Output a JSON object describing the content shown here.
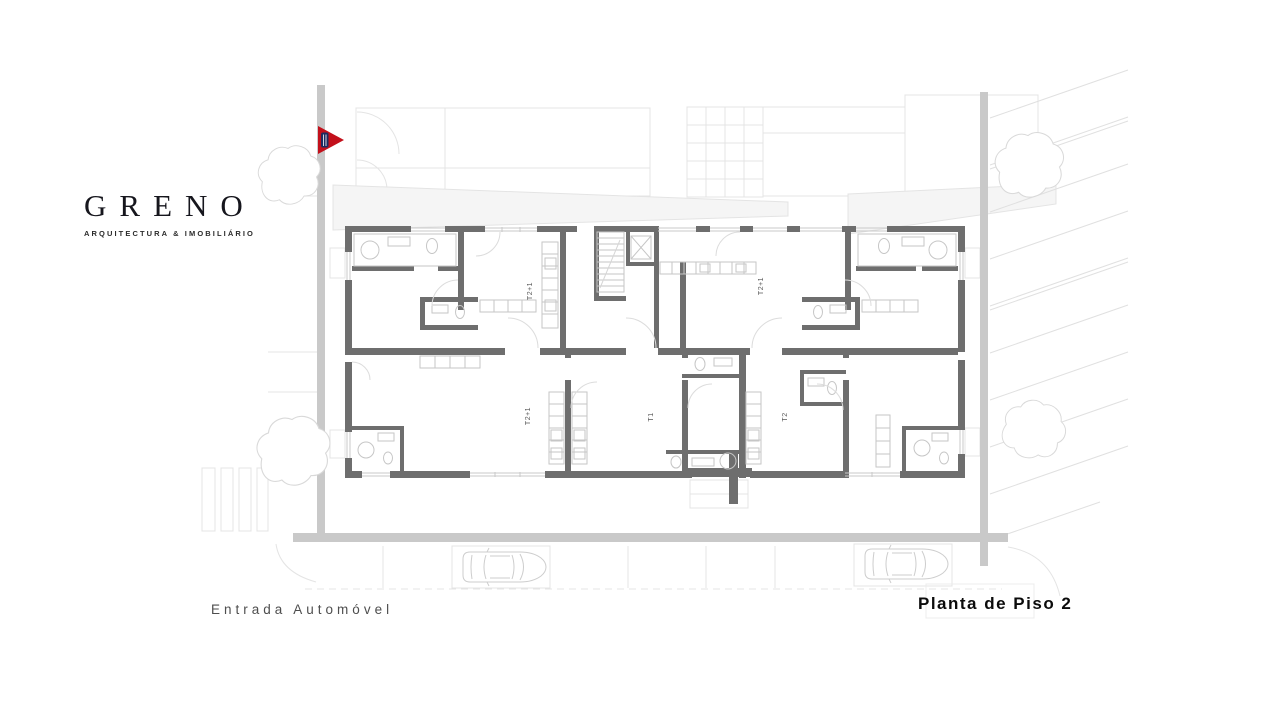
{
  "brand": {
    "name": "GRENO",
    "tagline": "ARQUITECTURA & IMOBILIÁRIO"
  },
  "captions": {
    "car_entrance": "Entrada Automóvel",
    "plan_title": "Planta de Piso 2"
  },
  "floor_plan": {
    "units": [
      {
        "id": "top-left",
        "label": "T2+1"
      },
      {
        "id": "top-right",
        "label": "T2+1"
      },
      {
        "id": "bottom-left",
        "label": "T2+1"
      },
      {
        "id": "bottom-center",
        "label": "T1"
      },
      {
        "id": "bottom-right",
        "label": "T2"
      }
    ],
    "marker": {
      "shape": "triangle-flag",
      "color": "#c3101b",
      "accent": "#1d2b5f"
    },
    "colors": {
      "wall": "#6e6e6e",
      "road": "#c9c9c9",
      "window": "#c9c9c9",
      "fixture": "#c6c6c6",
      "detail": "#dcdcdc",
      "site": "#e4e4e4",
      "tree": "#d9d9d9",
      "hatch": "#e0e0e0",
      "stipple": "#f5f5f5",
      "label": "#5a5a5a"
    }
  }
}
